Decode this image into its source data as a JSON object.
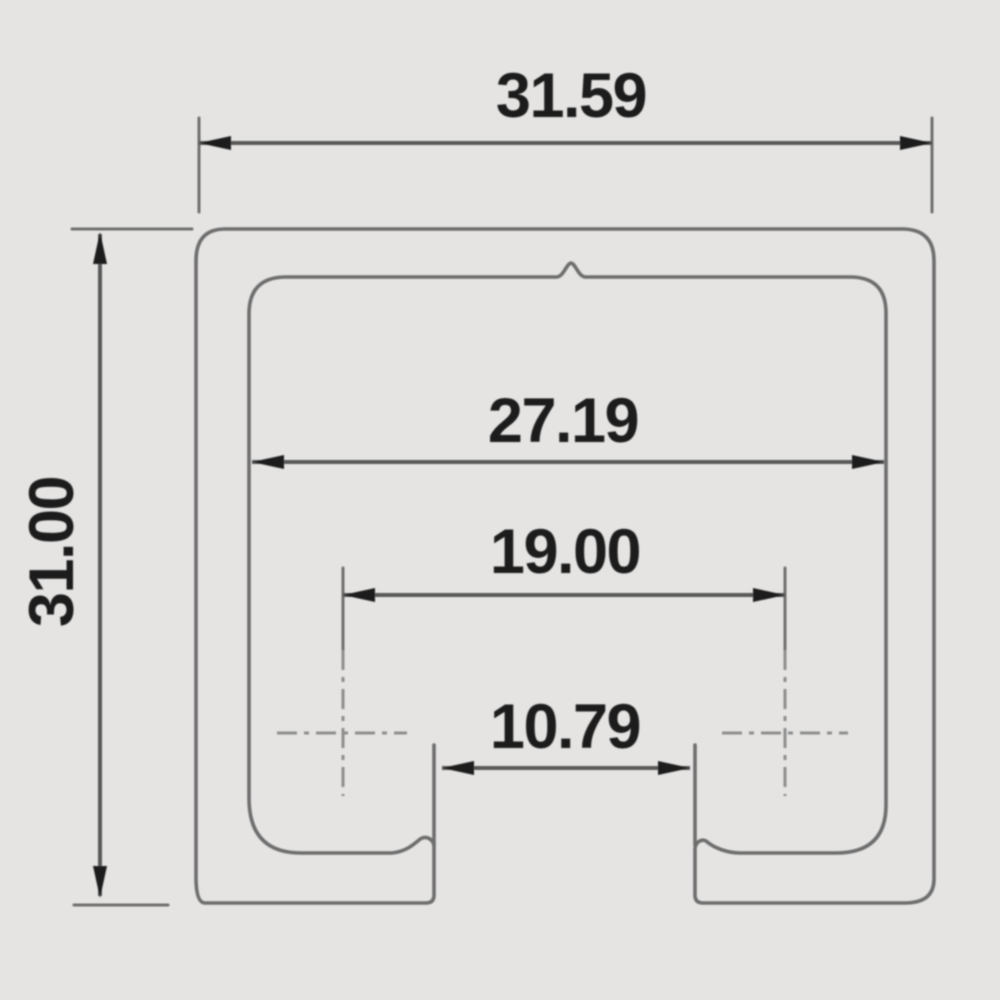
{
  "drawing": {
    "kind": "technical cross-section drawing",
    "subject": "C-channel sliding track profile",
    "colors": {
      "background": "#e5e4e3",
      "profile_line": "#6e6e6e",
      "dimension_line": "#5a5a5a",
      "extension_line": "#6f6f6f",
      "centerline": "#8e8e8e",
      "arrow_and_text": "#1a1a1a"
    },
    "dimensions": {
      "outer_width": "31.59",
      "overall_height": "31.00",
      "inner_width": "27.19",
      "roller_center_spacing": "19.00",
      "bottom_slot_width": "10.79"
    }
  }
}
